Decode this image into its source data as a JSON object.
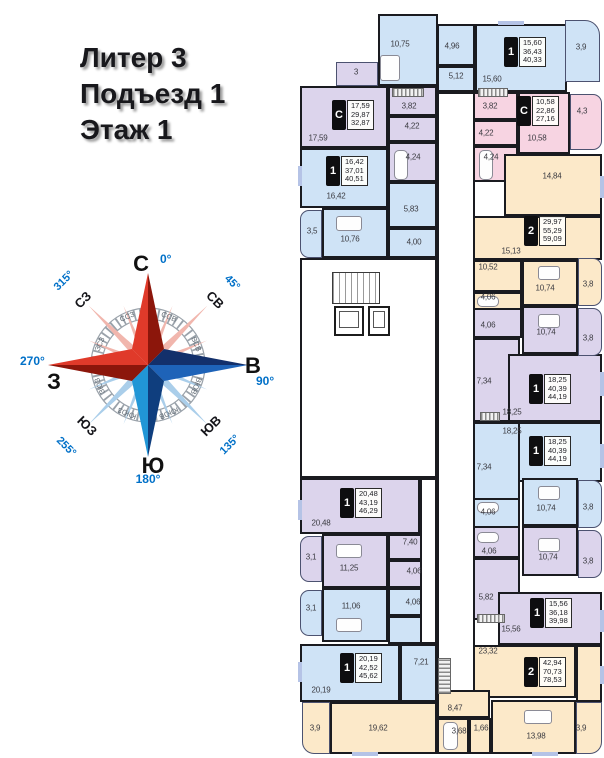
{
  "title": {
    "line1": "Литер 3",
    "line2": "Подъезд 1",
    "line3": "Этаж 1"
  },
  "compass": {
    "n": "С",
    "e": "В",
    "s": "Ю",
    "w": "З",
    "deg0": "0°",
    "deg45": "45°",
    "deg90": "90°",
    "deg135": "135°",
    "deg180": "180°",
    "deg255": "255°",
    "deg270": "270°",
    "deg315": "315°",
    "ne": "СВ",
    "nw": "СЗ",
    "se": "ЮВ",
    "sw": "ЮЗ",
    "nne": "ССВ",
    "ene": "ВСВ",
    "ese": "ВЮВ",
    "sse": "ЮЮВ",
    "ssw": "ЮЮЗ",
    "wsw": "ЗЮЗ",
    "wnw": "ЗСЗ",
    "nnw": "ССЗ"
  },
  "palette": {
    "blue": "#cfe3f6",
    "purple": "#dcd4ec",
    "pink": "#f7d4e2",
    "beige": "#fce9c9",
    "white": "#ffffff",
    "wall": "#1a1b20",
    "degree_blue": "#0070c8"
  },
  "apartments": [
    {
      "num": "1",
      "areas": [
        "15,60",
        "36,43",
        "40,33"
      ],
      "rooms": [
        "10,75",
        "4,96",
        "5,12",
        "15,60"
      ],
      "balcony": "3,9"
    },
    {
      "num": "С",
      "areas": [
        "17,59",
        "29,87",
        "32,87"
      ],
      "rooms": [
        "17,59",
        "3,82",
        "4,22",
        "4,24"
      ],
      "balcony": "3"
    },
    {
      "num": "С",
      "areas": [
        "10,58",
        "22,86",
        "27,16"
      ],
      "rooms": [
        "3,82",
        "4,22",
        "4,24",
        "10,58"
      ],
      "balcony": "4,3"
    },
    {
      "num": "1",
      "areas": [
        "16,42",
        "37,01",
        "40,51"
      ],
      "rooms": [
        "16,42",
        "10,76",
        "5,83",
        "4,00"
      ],
      "balcony": "3,5"
    },
    {
      "num": "2",
      "areas": [
        "29,97",
        "55,29",
        "59,09"
      ],
      "rooms": [
        "14,84",
        "15,13",
        "10,52",
        "4,06",
        "10,74"
      ],
      "balcony": "3,8"
    },
    {
      "num": "1",
      "areas": [
        "18,25",
        "40,39",
        "44,19"
      ],
      "rooms": [
        "4,06",
        "10,74",
        "7,34",
        "18,25"
      ],
      "balcony": "3,8"
    },
    {
      "num": "1",
      "areas": [
        "18,25",
        "40,39",
        "44,19"
      ],
      "rooms": [
        "18,25",
        "7,34",
        "10,74",
        "4,06"
      ],
      "balcony": "3,8"
    },
    {
      "num": "1",
      "areas": [
        "20,48",
        "43,19",
        "46,29"
      ],
      "rooms": [
        "20,48",
        "7,40",
        "11,25",
        "4,06"
      ],
      "balcony": "3,1"
    },
    {
      "num": "1",
      "areas": [
        "15,56",
        "36,18",
        "39,98"
      ],
      "rooms": [
        "4,06",
        "10,74",
        "5,82",
        "15,56"
      ],
      "balcony": "3,8"
    },
    {
      "num": "1",
      "areas": [
        "20,19",
        "42,52",
        "45,62"
      ],
      "rooms": [
        "11,06",
        "4,06",
        "20,19",
        "7,21"
      ],
      "balcony": "3,1"
    },
    {
      "num": "2",
      "areas": [
        "42,94",
        "70,73",
        "78,53"
      ],
      "rooms": [
        "23,32",
        "8,47",
        "19,62",
        "3,68",
        "1,66",
        "13,98"
      ],
      "balconies": [
        "3,9",
        "3,9"
      ]
    }
  ]
}
